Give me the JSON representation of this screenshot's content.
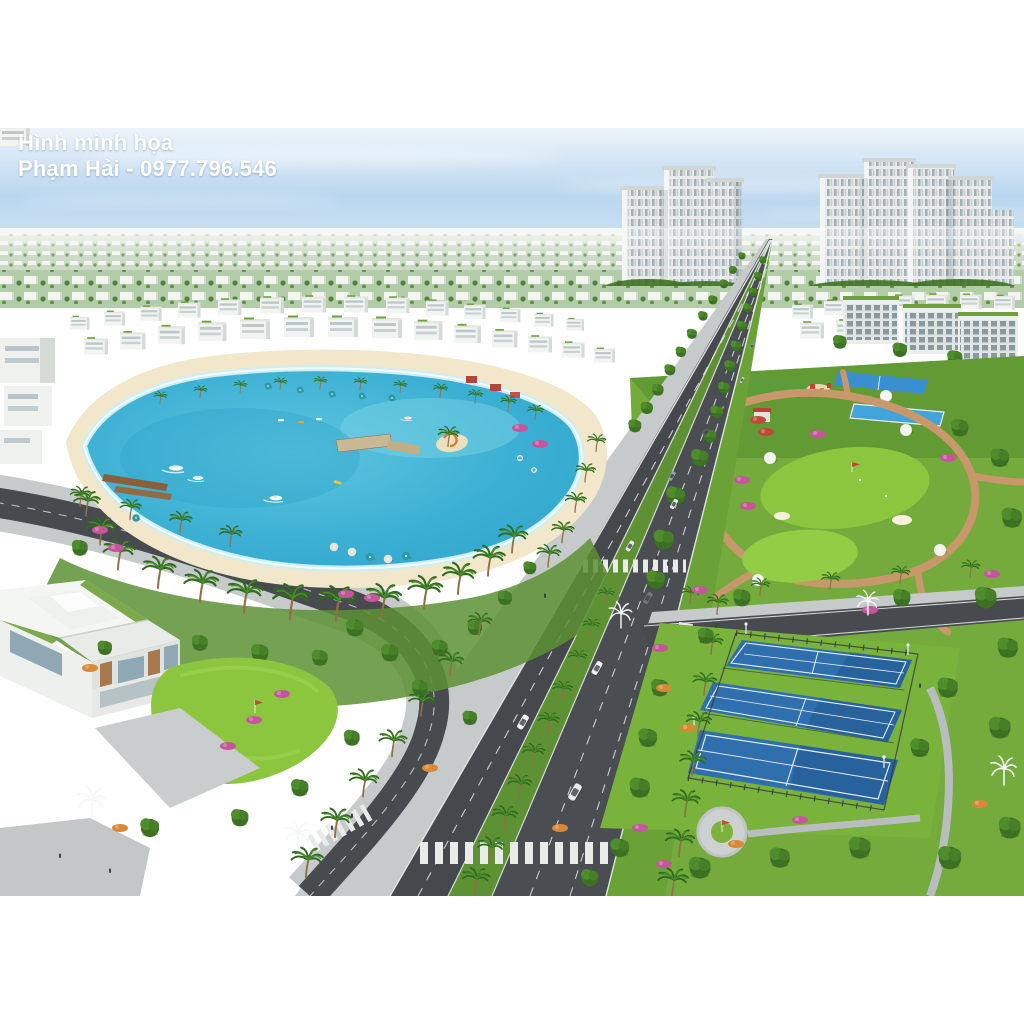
{
  "watermark": {
    "line1": "Hình minh họa",
    "line2": "Phạm Hải - 0977.796.546"
  },
  "scene": {
    "type": "aerial-3d-render",
    "setting": "resort-style urban development viewed from the air on a clear day",
    "elements": [
      "turquoise swim lagoon ringed by white sand beach and palm trees",
      "boats, kayaks, wooden piers and a T-shaped pier on the lagoon",
      "palm-lined boulevard with dual carriageways, green median, crosswalks and cars",
      "curving lakeside road with paved sidewalks at lower left",
      "two clusters of white high-rise towers on the horizon",
      "dense field of white low-rise townhouses to the horizon",
      "central park with winding paths, putting greens, white umbrellas and flower beds",
      "sports zone with lap pool, courts and playground",
      "three blue tennis courts with dark fencing at lower right",
      "modern white villa with rooftop gardens and private putting green at lower left",
      "ornamental white fountain-shaped street lamps"
    ],
    "counts": {
      "tennis_courts": 3,
      "tower_clusters": 2,
      "crosswalks": 4
    }
  },
  "colors": {
    "sky_top": "#edf4fb",
    "sky_mid": "#b9d6ee",
    "sky_horizon": "#e6eff6",
    "water_deep": "#2ea3cb",
    "water_mid": "#4db9d8",
    "water_shallow": "#a7e0ea",
    "sand": "#f2e7cb",
    "grass": "#74ab3c",
    "grass_bright": "#8cc63f",
    "foliage_dark": "#3f7222",
    "foliage_mid": "#559130",
    "asphalt": "#45484c",
    "paver": "#c6cacb",
    "path_tan": "#c8976b",
    "building_white": "#f2f4f1",
    "building_shadow": "#d5dad6",
    "window_gray": "#9fb0b8",
    "court_blue": "#2f6fae",
    "pool_blue": "#41a5dc",
    "fence_dark": "#33383c",
    "flower_pink": "#c5569b",
    "flower_orange": "#d98936",
    "flower_red": "#c24a3a",
    "wood_brown": "#8a5f3a",
    "lamp_white": "#f5f8f8",
    "watermark_white": "#ffffff"
  }
}
